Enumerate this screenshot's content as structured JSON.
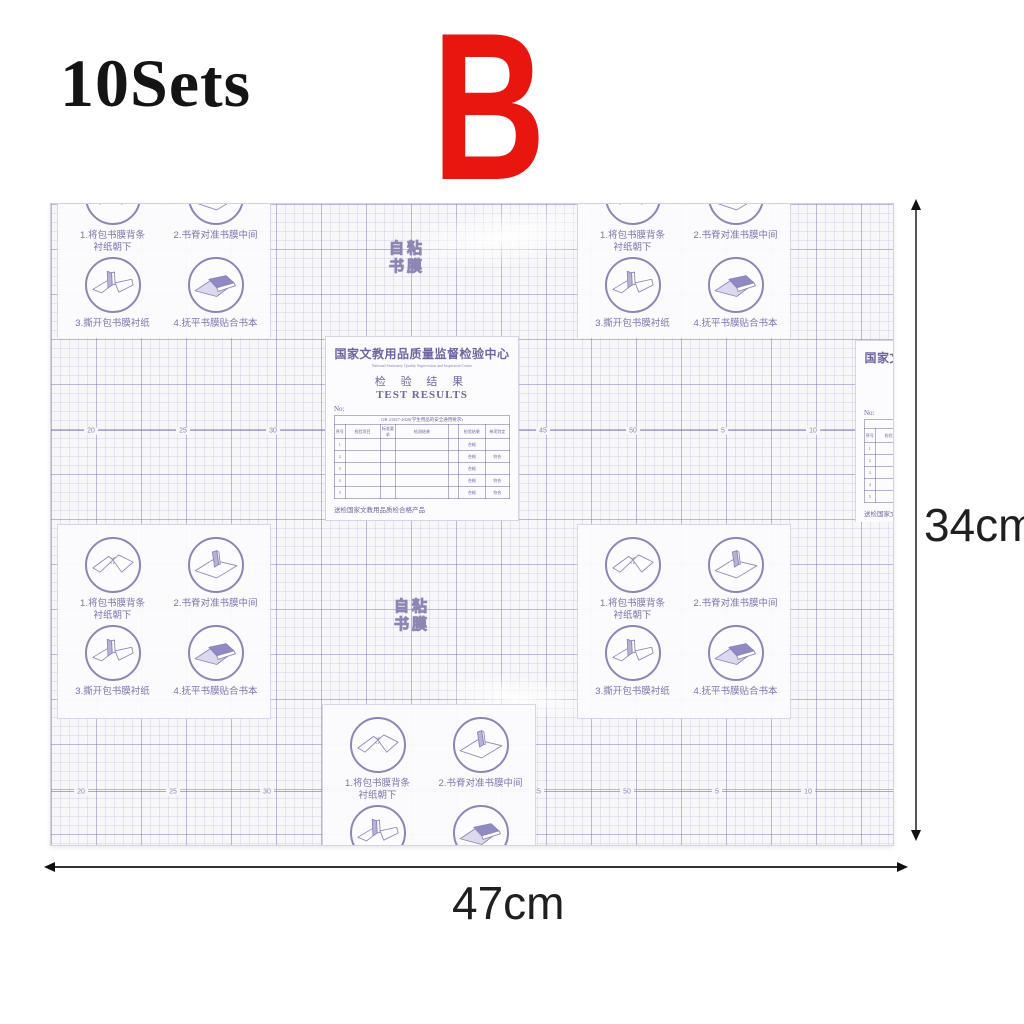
{
  "header": {
    "quantity": "10Sets",
    "variant": "B"
  },
  "colors": {
    "variant_red": "#e9150f",
    "print_purple": "#7d76ab",
    "grid_purple": "#8d86b5"
  },
  "dimensions": {
    "height": "34cm",
    "width": "47cm"
  },
  "sheet": {
    "brand_chars": [
      "自",
      "粘",
      "书",
      "膜"
    ],
    "steps": [
      {
        "label": "1.将包书膜背条\n衬纸朝下"
      },
      {
        "label": "2.书脊对准书膜中间"
      },
      {
        "label": "3.撕开包书膜衬纸"
      },
      {
        "label": "4.抚平书膜贴合书本"
      }
    ],
    "certificate": {
      "org_cn": "国家文教用品质量监督检验中心",
      "org_en": "National Stationery Quality Supervision and Inspection Center",
      "result_cn": "检 验 结 果",
      "result_en": "TEST RESULTS",
      "no_label": "No:",
      "standard": "GB 21027-2020(学生用品的安全通用要求)",
      "columns": [
        "序号",
        "检验项目",
        "标准要求",
        "检测结果",
        "",
        "检验结果",
        "单项判定"
      ],
      "rows": [
        [
          "1",
          "",
          "",
          "",
          "",
          "合格",
          ""
        ],
        [
          "2",
          "",
          "",
          "",
          "",
          "合格",
          "符合"
        ],
        [
          "3",
          "",
          "",
          "",
          "",
          "合格",
          ""
        ],
        [
          "4",
          "",
          "",
          "",
          "",
          "合格",
          "符合"
        ],
        [
          "5",
          "",
          "",
          "",
          "",
          "合格",
          "符合"
        ]
      ],
      "footer": "送检国家文教用品质检合格产品"
    },
    "ruler_row1": [
      "20",
      "25",
      "30",
      "45",
      "50",
      "5",
      "10"
    ],
    "ruler_row2": [
      "20",
      "25",
      "30",
      "45",
      "50",
      "5",
      "10"
    ]
  }
}
